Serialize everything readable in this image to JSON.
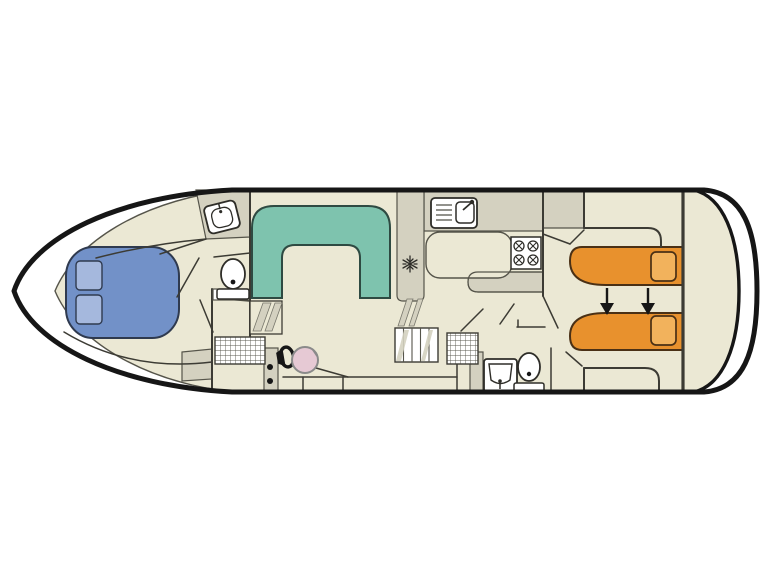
{
  "diagram": {
    "type": "boat-floor-plan",
    "description": "Top-down deck plan of a motor cruiser houseboat"
  },
  "colors": {
    "background": "#ffffff",
    "hull_outline": "#161616",
    "wall": "#3c3b34",
    "floor": "#ebe8d4",
    "floor_shaded": "#d4d1c0",
    "fixture": "#ffffff",
    "fixture_stroke": "#2e2d28",
    "bow_bed": "#7291c8",
    "bow_bed_pillow": "#a5b8dd",
    "bow_bed_stroke": "#2f3a4f",
    "dinette": "#7ec3ae",
    "dinette_stroke": "#2e4a42",
    "aft_bed": "#e8912d",
    "aft_bed_pillow": "#f2b25c",
    "aft_bed_stroke": "#4a3015",
    "helm_seat": "#e6c9d4",
    "helm_seat_stroke": "#8a8a8a",
    "icon_dark": "#161616",
    "minor_line": "#55544a"
  },
  "areas": [
    {
      "name": "bow-cabin",
      "furniture": "double-bed"
    },
    {
      "name": "forward-bathroom",
      "furniture": "washbasin, toilet"
    },
    {
      "name": "saloon",
      "furniture": "u-shaped-dinette"
    },
    {
      "name": "galley",
      "furniture": "sink, stove, fridge, counters"
    },
    {
      "name": "helm-station",
      "furniture": "steering-wheel, pilot-seat"
    },
    {
      "name": "aft-bathroom",
      "furniture": "shower-grate, washbasin, toilet"
    },
    {
      "name": "aft-cabin",
      "furniture": "twin-single-beds-convertible"
    }
  ],
  "icons": [
    "washbasin-icon",
    "toilet-icon",
    "galley-sink-icon",
    "stove-burners-icon",
    "snowflake-fridge-icon",
    "steering-wheel-icon",
    "helm-seat",
    "stairs-icon",
    "shower-grate-icon",
    "bed-convert-arrow-icon"
  ]
}
